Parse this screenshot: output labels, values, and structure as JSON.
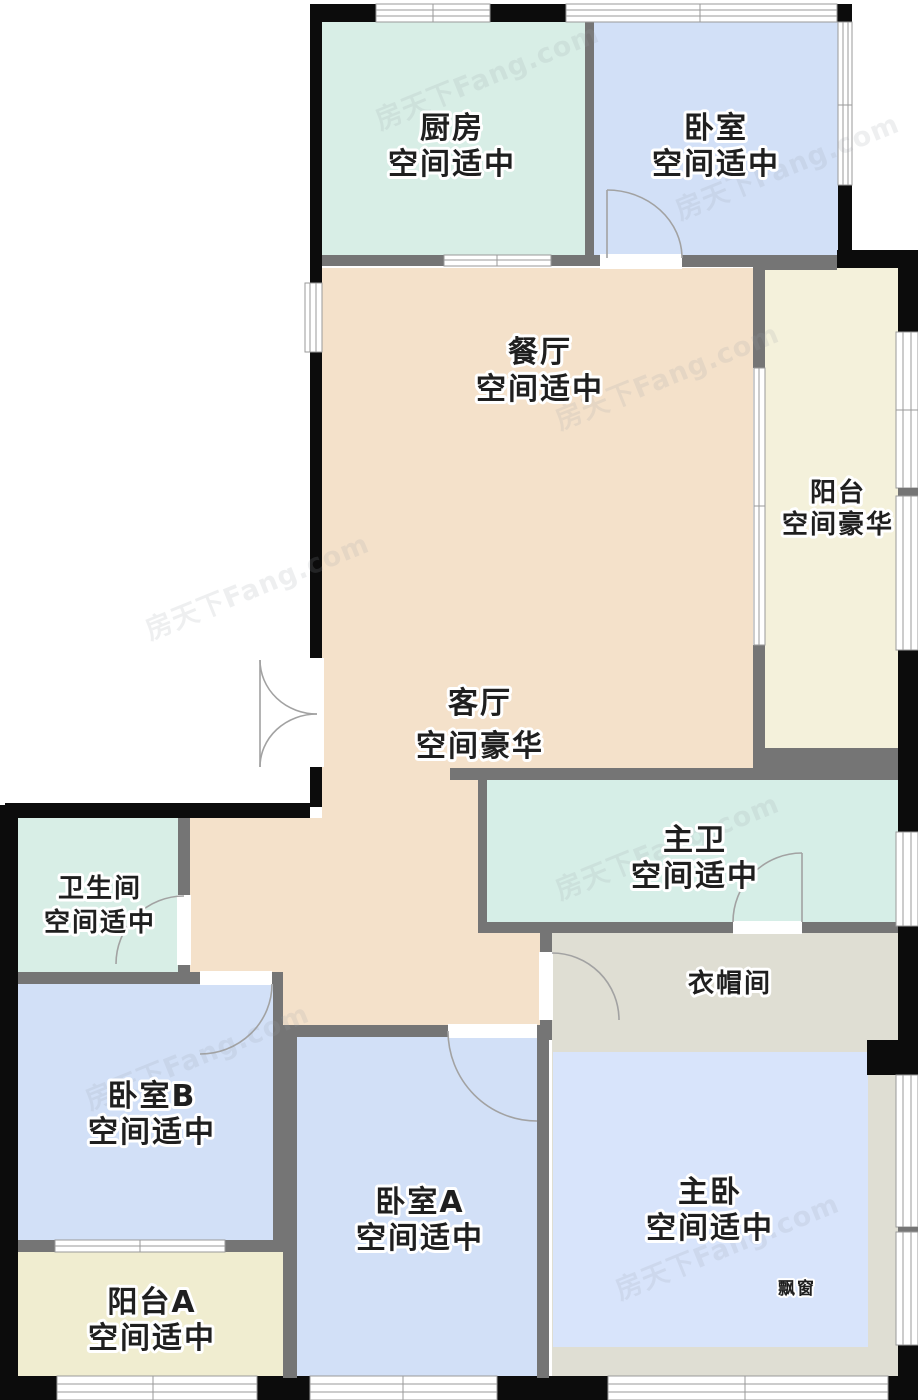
{
  "watermark": {
    "text": "房天下Fang.com"
  },
  "rooms": {
    "kitchen": {
      "name": "厨房",
      "size": "空间适中"
    },
    "bedroom_top": {
      "name": "卧室",
      "size": "空间适中"
    },
    "dining": {
      "name": "餐厅",
      "size": "空间适中"
    },
    "balcony_right": {
      "name": "阳台",
      "size": "空间豪华"
    },
    "living": {
      "name": "客厅",
      "size": "空间豪华"
    },
    "master_bath": {
      "name": "主卫",
      "size": "空间适中"
    },
    "bathroom": {
      "name": "卫生间",
      "size": "空间适中"
    },
    "cloakroom": {
      "name": "衣帽间"
    },
    "bedroom_b": {
      "name": "卧室B",
      "size": "空间适中"
    },
    "balcony_a": {
      "name": "阳台A",
      "size": "空间适中"
    },
    "bedroom_a": {
      "name": "卧室A",
      "size": "空间适中"
    },
    "master_bedroom": {
      "name": "主卧",
      "size": "空间适中"
    },
    "bay_window": {
      "name": "飘窗"
    }
  },
  "colors": {
    "living_dining": "#f4e1ca",
    "kitchen": "#d8eee6",
    "bathroom": "#d8eee6",
    "master_bathroom": "#d6eee7",
    "bedroom": "#d2e0f7",
    "master_bedroom": "#d8e4fb",
    "balcony": "#f4f1db",
    "balcony_a": "#f0edd0",
    "cloakroom": "#dfded3",
    "wall_exterior": "#0c0c0c",
    "wall_interior": "#757575",
    "watermark_gray": "#9aa0a8"
  }
}
